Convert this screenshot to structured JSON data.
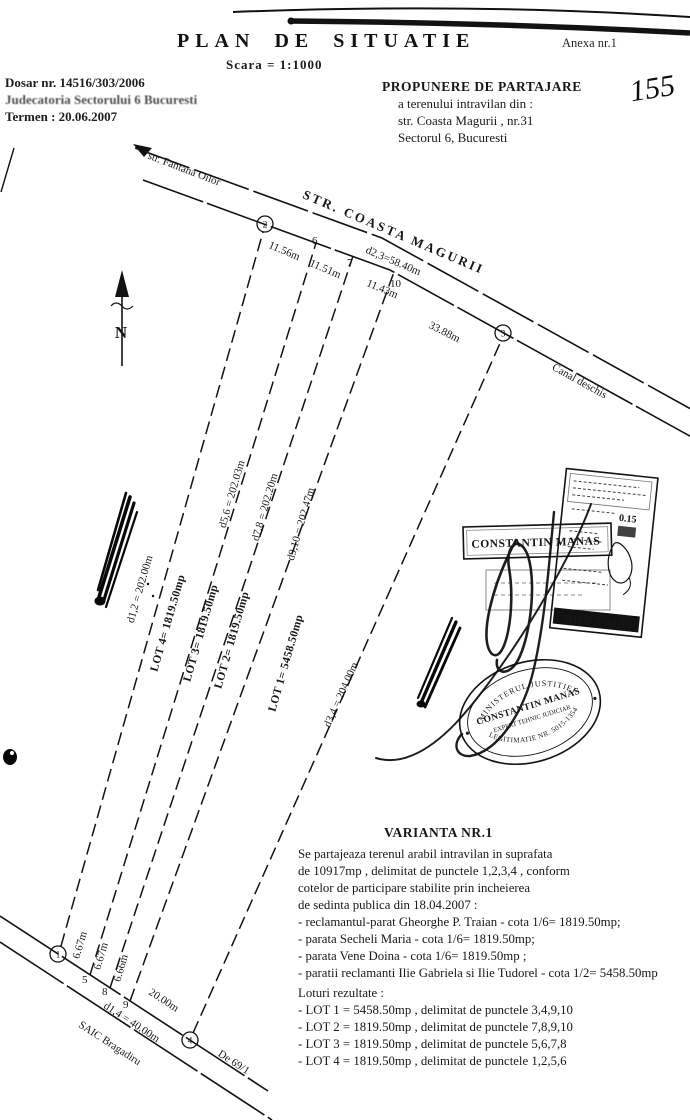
{
  "header": {
    "title": "PLAN DE SITUATIE",
    "annex": "Anexa nr.1",
    "scale": "Scara = 1:1000",
    "dosar": "Dosar nr. 14516/303/2006",
    "court": "Judecatoria Sectorului 6 Bucuresti",
    "termen": "Termen : 20.06.2007",
    "proposal": {
      "line1": "PROPUNERE DE PARTAJARE",
      "line2": "a terenului intravilan din :",
      "line3": "str. Coasta Magurii , nr.31",
      "line4": "Sectorul 6, Bucuresti"
    },
    "page_number": "155"
  },
  "plan": {
    "north": "N",
    "streets": {
      "fantana": "str. Fantana Oilor",
      "magurii": "STR. COASTA MAGURII",
      "canal": "Canal deschis",
      "bragadiru": "SAIC Bragadiru",
      "de691": "De 69/1"
    },
    "points": {
      "p1": "1",
      "p2": "2",
      "p3": "3",
      "p4": "4",
      "p5": "5",
      "p6": "6",
      "p7": "7",
      "p8": "8",
      "p9": "9",
      "p10": "10"
    },
    "dims": {
      "d23": "d2,3=58.40m",
      "s26": "11.56m",
      "s67": "11.51m",
      "s710": "11.43m",
      "s103": "33.88m",
      "d12": "d1,2 = 202.00m",
      "d56": "d5,6 = 202.03m",
      "d78": "d7,8 = 202.20m",
      "d910": "d9,10 = 202.47m",
      "d34": "d3,4 = 204.00m",
      "d14": "d1,4 = 40.00m",
      "s15": "6.67m",
      "s58": "6.67m",
      "s89": "6.66m",
      "s94": "20.00m"
    },
    "lots": {
      "lot1": "LOT 1= 5458.50mp",
      "lot2": "LOT 2= 1819.50mp",
      "lot3": "LOT 3= 1819.50mp",
      "lot4": "LOT 4= 1819.50mp"
    }
  },
  "stamps": {
    "fiscal": {
      "value": "0.15",
      "country": "ROMANIA"
    },
    "name": "CONSTANTIN MANAS",
    "round": {
      "top": "MINISTERUL JUSTITIEI",
      "name": "CONSTANTIN MANAS",
      "role": "EXPERT TEHNIC JUDICIAR",
      "bottom": "LEGITIMATIE NR. 5015-1354"
    }
  },
  "variant": {
    "title": "VARIANTA NR.1",
    "body": [
      "Se partajeaza terenul arabil intravilan in suprafata",
      "de 10917mp , delimitat de punctele 1,2,3,4 , conform",
      "cotelor de participare stabilite prin incheierea",
      "de sedinta publica din 18.04.2007 :",
      "- reclamantul-parat Gheorghe P. Traian - cota 1/6= 1819.50mp;",
      "- parata Secheli Maria - cota 1/6= 1819.50mp;",
      "- parata Vene Doina - cota 1/6= 1819.50mp ;",
      "- paratii reclamanti Ilie Gabriela si Ilie Tudorel - cota 1/2= 5458.50mp"
    ],
    "lots_title": "Loturi rezultate :",
    "lots": [
      "- LOT 1 = 5458.50mp , delimitat de punctele 3,4,9,10",
      "- LOT 2 = 1819.50mp , delimitat de punctele 7,8,9,10",
      "- LOT 3 = 1819.50mp , delimitat de punctele 5,6,7,8",
      "- LOT 4 = 1819.50mp , delimitat de punctele 1,2,5,6"
    ]
  }
}
